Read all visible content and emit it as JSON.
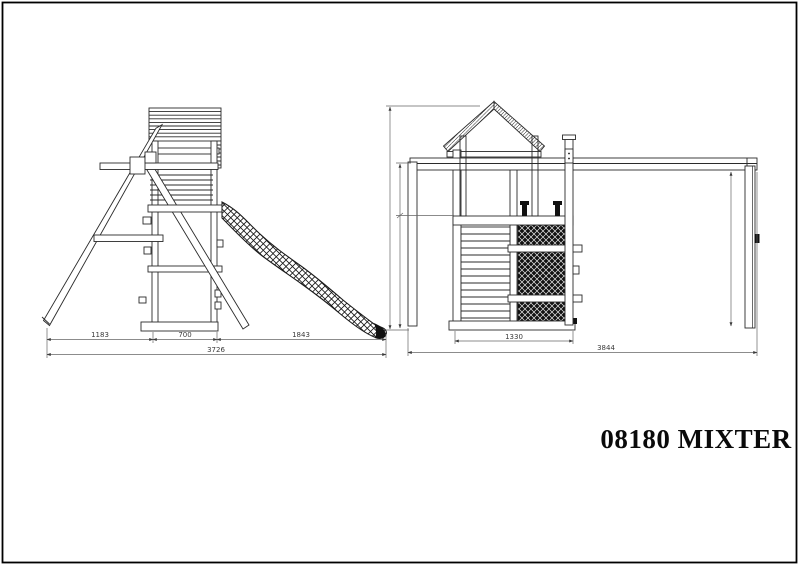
{
  "page": {
    "background": "#ffffff",
    "frame_color": "#000000",
    "line_color": "#2b2b2b",
    "dim_color": "#3a3a3a"
  },
  "title": "08180 MIXTER",
  "views": {
    "side": {
      "dims": {
        "swing_section": "1183",
        "tower_width": "700",
        "slide_section": "1843",
        "total_length": "3726"
      }
    },
    "front": {
      "dims": {
        "tower_width": "1330",
        "total_length": "3844"
      }
    }
  }
}
